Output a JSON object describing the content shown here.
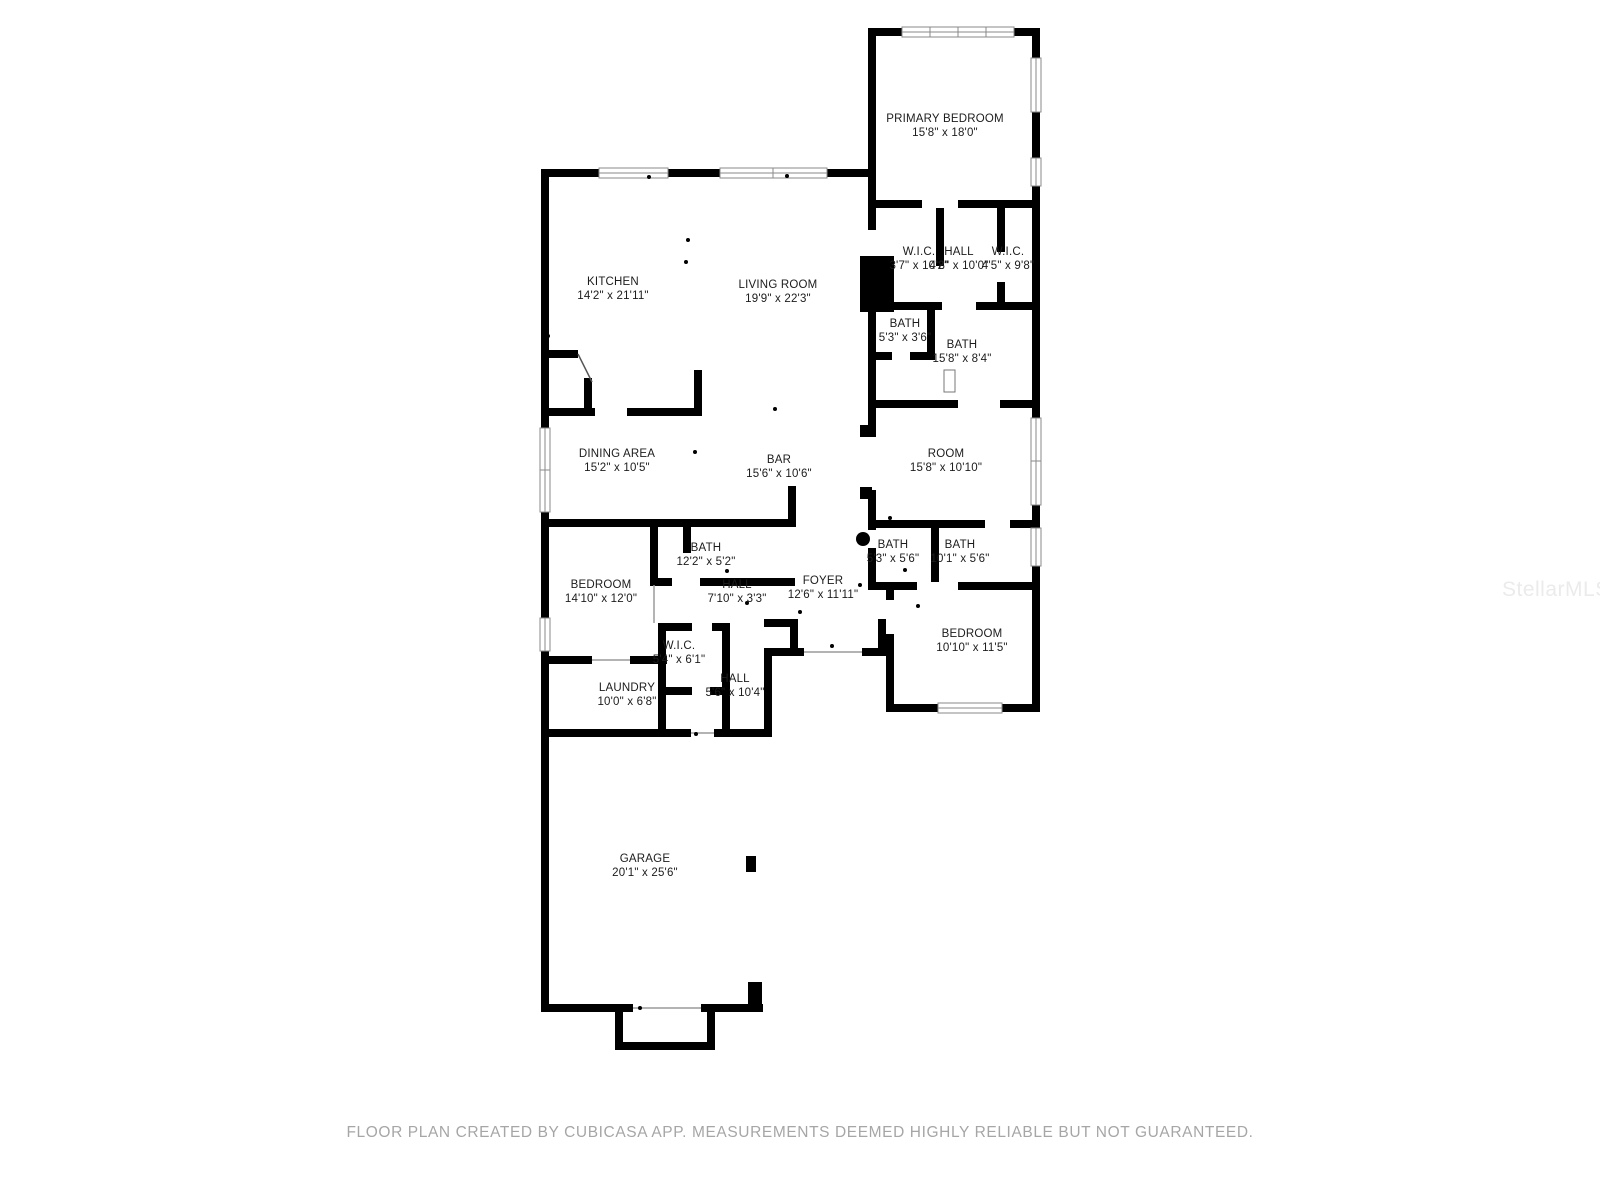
{
  "page": {
    "background": "#ffffff",
    "footer_text": "FLOOR PLAN CREATED BY CUBICASA APP. MEASUREMENTS DEEMED HIGHLY RELIABLE BUT NOT GUARANTEED.",
    "watermark_text": "StellarMLS"
  },
  "colors": {
    "wall": "#000000",
    "label_text": "#1c1c1c",
    "window_frame": "#8a8a8a",
    "footer_text": "#a6a6a6",
    "watermark": "#ebebeb"
  },
  "floor_plan": {
    "rooms": [
      {
        "name": "PRIMARY BEDROOM",
        "dims": "15'8\" x 18'0\"",
        "cx": 945,
        "cy": 126
      },
      {
        "name": "KITCHEN",
        "dims": "14'2\" x 21'11\"",
        "cx": 613,
        "cy": 289
      },
      {
        "name": "LIVING ROOM",
        "dims": "19'9\" x 22'3\"",
        "cx": 778,
        "cy": 292
      },
      {
        "name": "W.I.C.",
        "dims": "3'7\" x 10'2\"",
        "cx": 919,
        "cy": 259
      },
      {
        "name": "HALL",
        "dims": "4'8\" x 10'0\"",
        "cx": 959,
        "cy": 259
      },
      {
        "name": "W.I.C.",
        "dims": "4'5\" x 9'8\"",
        "cx": 1008,
        "cy": 259
      },
      {
        "name": "BATH",
        "dims": "5'3\" x 3'6\"",
        "cx": 905,
        "cy": 331
      },
      {
        "name": "BATH",
        "dims": "15'8\" x 8'4\"",
        "cx": 962,
        "cy": 352
      },
      {
        "name": "DINING AREA",
        "dims": "15'2\" x 10'5\"",
        "cx": 617,
        "cy": 461
      },
      {
        "name": "BAR",
        "dims": "15'6\" x 10'6\"",
        "cx": 779,
        "cy": 467
      },
      {
        "name": "ROOM",
        "dims": "15'8\" x 10'10\"",
        "cx": 946,
        "cy": 461
      },
      {
        "name": "BATH",
        "dims": "12'2\" x 5'2\"",
        "cx": 706,
        "cy": 555
      },
      {
        "name": "BEDROOM",
        "dims": "14'10\" x 12'0\"",
        "cx": 601,
        "cy": 592
      },
      {
        "name": "HALL",
        "dims": "7'10\" x 3'3\"",
        "cx": 737,
        "cy": 592
      },
      {
        "name": "FOYER",
        "dims": "12'6\" x 11'11\"",
        "cx": 823,
        "cy": 588
      },
      {
        "name": "BATH",
        "dims": "5'3\" x 5'6\"",
        "cx": 893,
        "cy": 552
      },
      {
        "name": "BATH",
        "dims": "10'1\" x 5'6\"",
        "cx": 960,
        "cy": 552
      },
      {
        "name": "BEDROOM",
        "dims": "10'10\" x 11'5\"",
        "cx": 972,
        "cy": 641
      },
      {
        "name": "W.I.C.",
        "dims": "5'4\" x 6'1\"",
        "cx": 679,
        "cy": 653
      },
      {
        "name": "LAUNDRY",
        "dims": "10'0\" x 6'8\"",
        "cx": 627,
        "cy": 695
      },
      {
        "name": "HALL",
        "dims": "5'6\" x 10'4\"",
        "cx": 735,
        "cy": 686
      },
      {
        "name": "GARAGE",
        "dims": "20'1\" x 25'6\"",
        "cx": 645,
        "cy": 866
      }
    ]
  }
}
